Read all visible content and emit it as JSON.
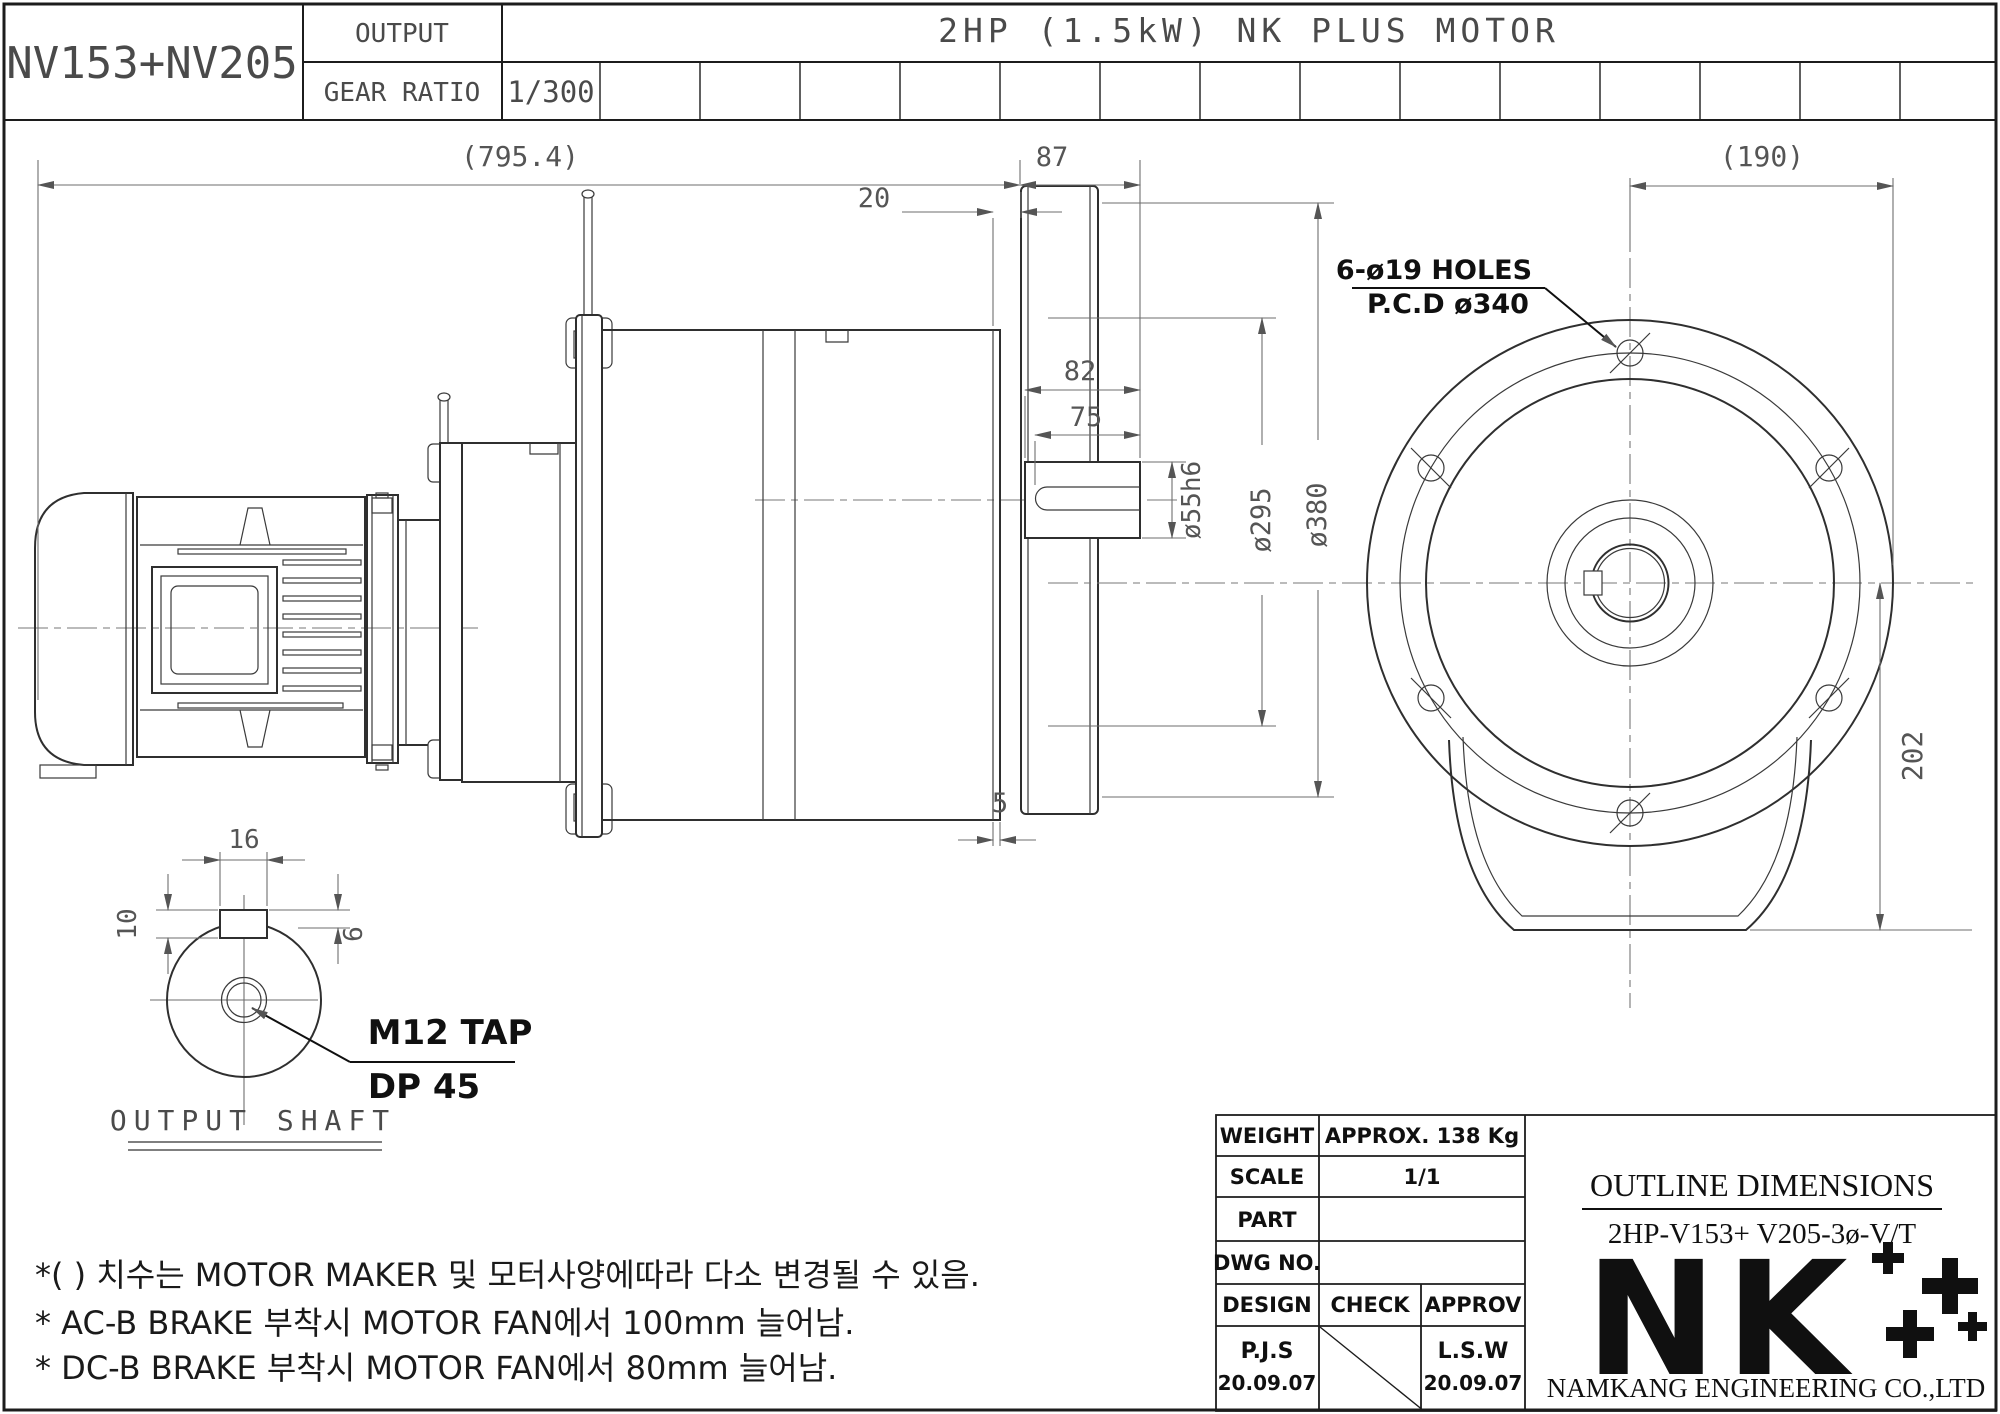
{
  "header": {
    "model_code": "NV153+NV205",
    "output_label": "OUTPUT",
    "gear_ratio_label": "GEAR RATIO",
    "gear_ratio_value": "1/300",
    "title": "2HP (1.5kW) NK PLUS MOTOR"
  },
  "side_view": {
    "dims": {
      "overall": "(795.4)",
      "gap20": "20",
      "len87": "87",
      "len82": "82",
      "len75": "75",
      "shaft_dia": "ø55h6",
      "boss_dia": "ø295",
      "flange_dia": "ø380",
      "wall5": "5"
    }
  },
  "front_view": {
    "dims": {
      "radius190": "(190)",
      "height202": "202",
      "holes_note_line1": "6-ø19 HOLES",
      "holes_note_line2": "P.C.D ø340"
    }
  },
  "detail_view": {
    "title": "OUTPUT SHAFT",
    "dims": {
      "key_w": "16",
      "key_h10": "10",
      "key_h6": "6",
      "tap_line1": "M12 TAP",
      "tap_line2": "DP 45"
    }
  },
  "notes": {
    "line1": "*(  ) 치수는 MOTOR MAKER 및 모터사양에따라 다소 변경될 수 있음.",
    "line2": "* AC-B BRAKE 부착시 MOTOR FAN에서 100mm 늘어남.",
    "line3": "* DC-B BRAKE 부착시 MOTOR FAN에서 80mm 늘어남."
  },
  "title_block": {
    "weight_label": "WEIGHT",
    "weight_value": "APPROX. 138 Kg",
    "scale_label": "SCALE",
    "scale_value": "1/1",
    "part_label": "PART",
    "dwg_label": "DWG NO.",
    "design_label": "DESIGN",
    "check_label": "CHECK",
    "approv_label": "APPROV",
    "designer": "P.J.S",
    "design_date": "20.09.07",
    "approver": "L.S.W",
    "approve_date": "20.09.07",
    "doc_title": "OUTLINE DIMENSIONS",
    "doc_model": "2HP-V153+ V205-3ø-V/T",
    "logo": "NK",
    "company": "NAMKANG ENGINEERING CO.,LTD"
  },
  "colors": {
    "line": "#2f2f2f",
    "dim": "#6e6e6e",
    "text": "#4a4a4a",
    "accent": "#101010",
    "paper": "#ffffff"
  }
}
